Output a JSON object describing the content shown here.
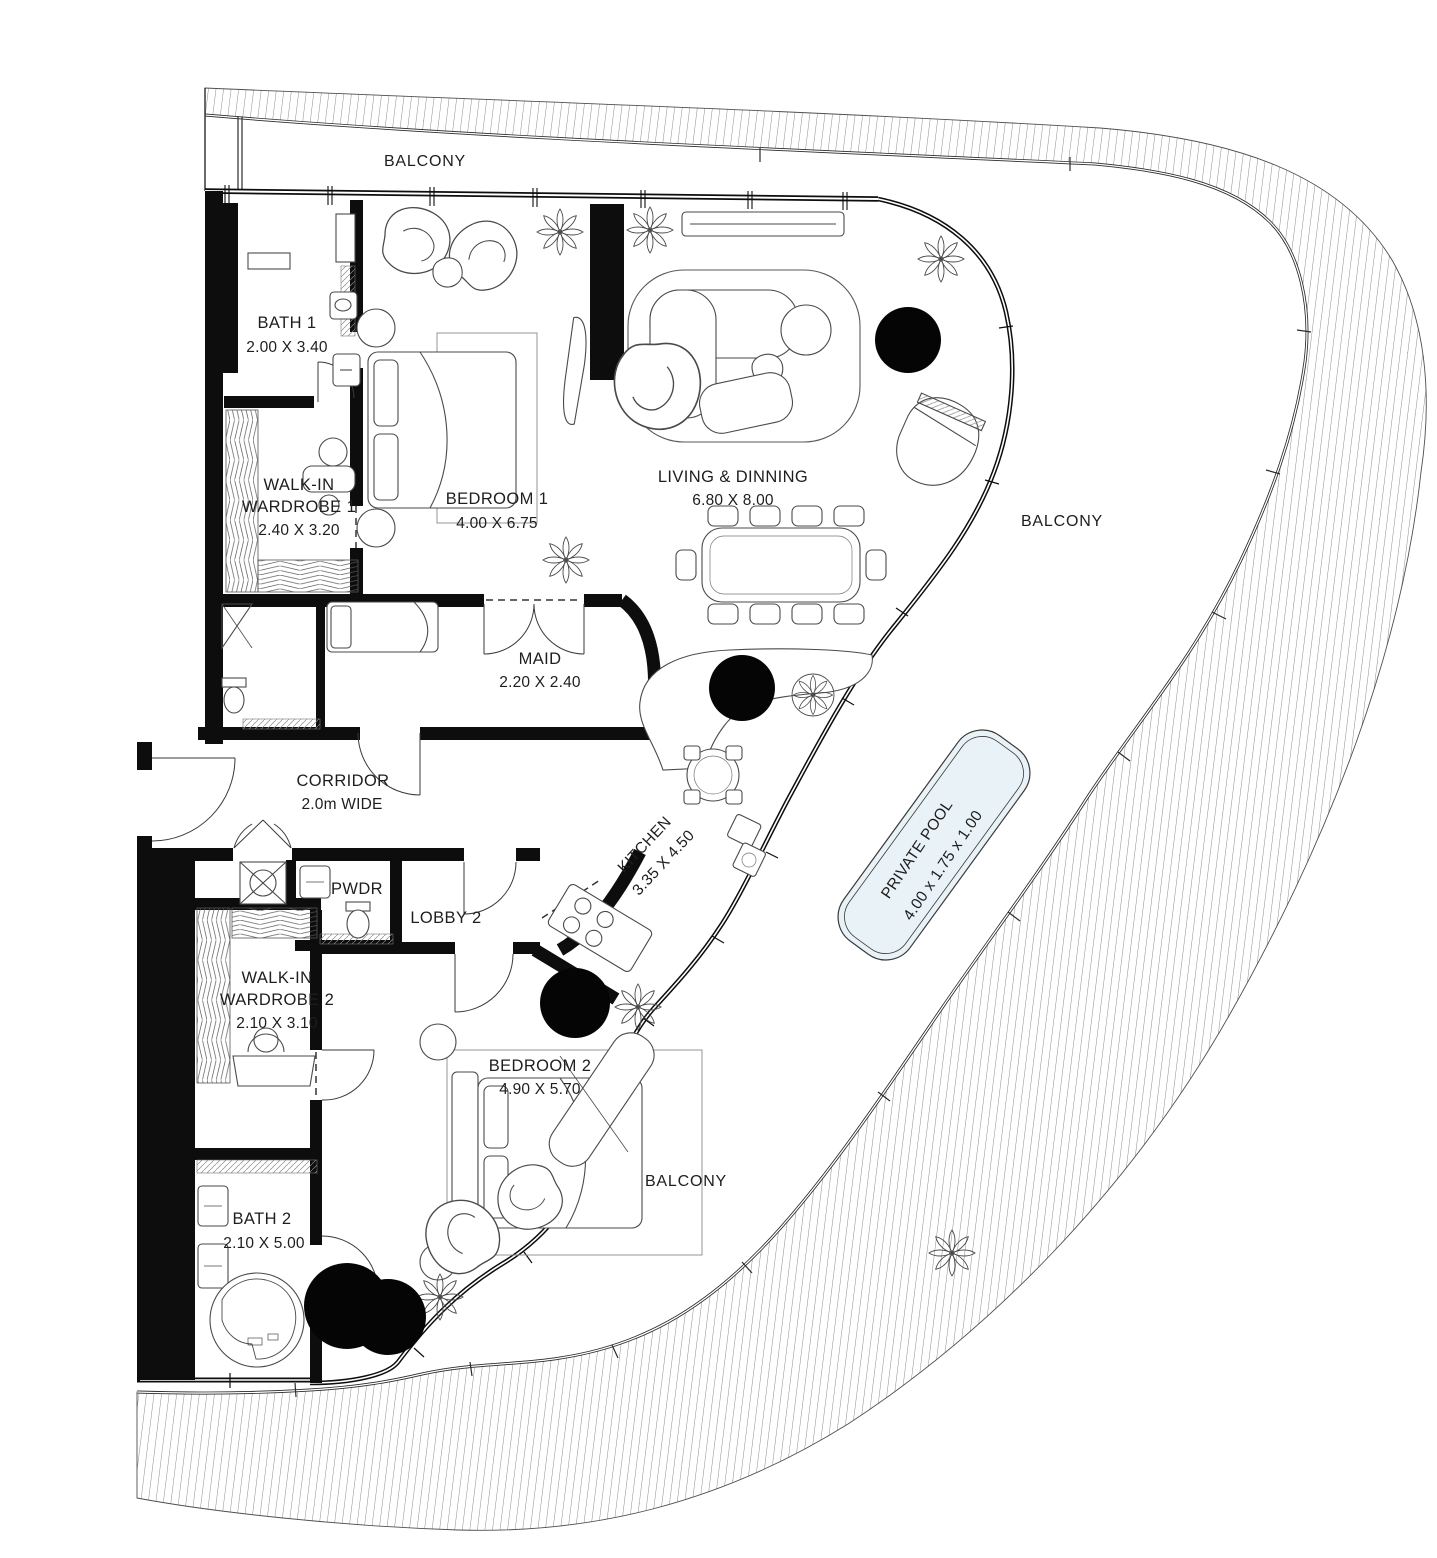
{
  "plan_title": "apartment-floor-plan",
  "colors": {
    "wall": "#0d0d0d",
    "line": "#3c3c3c",
    "light_line": "#7a7a7a",
    "pool_fill": "#e9f2f6",
    "text": "#1e1e1e"
  },
  "balconies": {
    "top": "BALCONY",
    "right": "BALCONY",
    "bottom": "BALCONY"
  },
  "rooms": {
    "bath1": {
      "name": "BATH 1",
      "dims": "2.00 X 3.40"
    },
    "wardrobe1": {
      "line1": "WALK-IN",
      "line2": "WARDROBE 1",
      "dims": "2.40 X 3.20"
    },
    "bedroom1": {
      "name": "BEDROOM 1",
      "dims": "4.00 X 6.75"
    },
    "living": {
      "name": "LIVING & DINNING",
      "dims": "6.80 X 8.00"
    },
    "maid": {
      "name": "MAID",
      "dims": "2.20 X 2.40"
    },
    "corridor": {
      "name": "CORRIDOR",
      "dims": "2.0m WIDE"
    },
    "kitchen": {
      "name": "KITCHEN",
      "dims": "3.35 X 4.50"
    },
    "pwdr": {
      "name": "PWDR"
    },
    "lobby2": {
      "name": "LOBBY 2"
    },
    "wardrobe2": {
      "line1": "WALK-IN",
      "line2": "WARDROBE 2",
      "dims": "2.10 X 3.10"
    },
    "bedroom2": {
      "name": "BEDROOM 2",
      "dims": "4.90 X 5.70"
    },
    "bath2": {
      "name": "BATH 2",
      "dims": "2.10 X 5.00"
    },
    "pool": {
      "name": "PRIVATE POOL",
      "dims": "4.00 x 1.75 x 1.00"
    }
  }
}
